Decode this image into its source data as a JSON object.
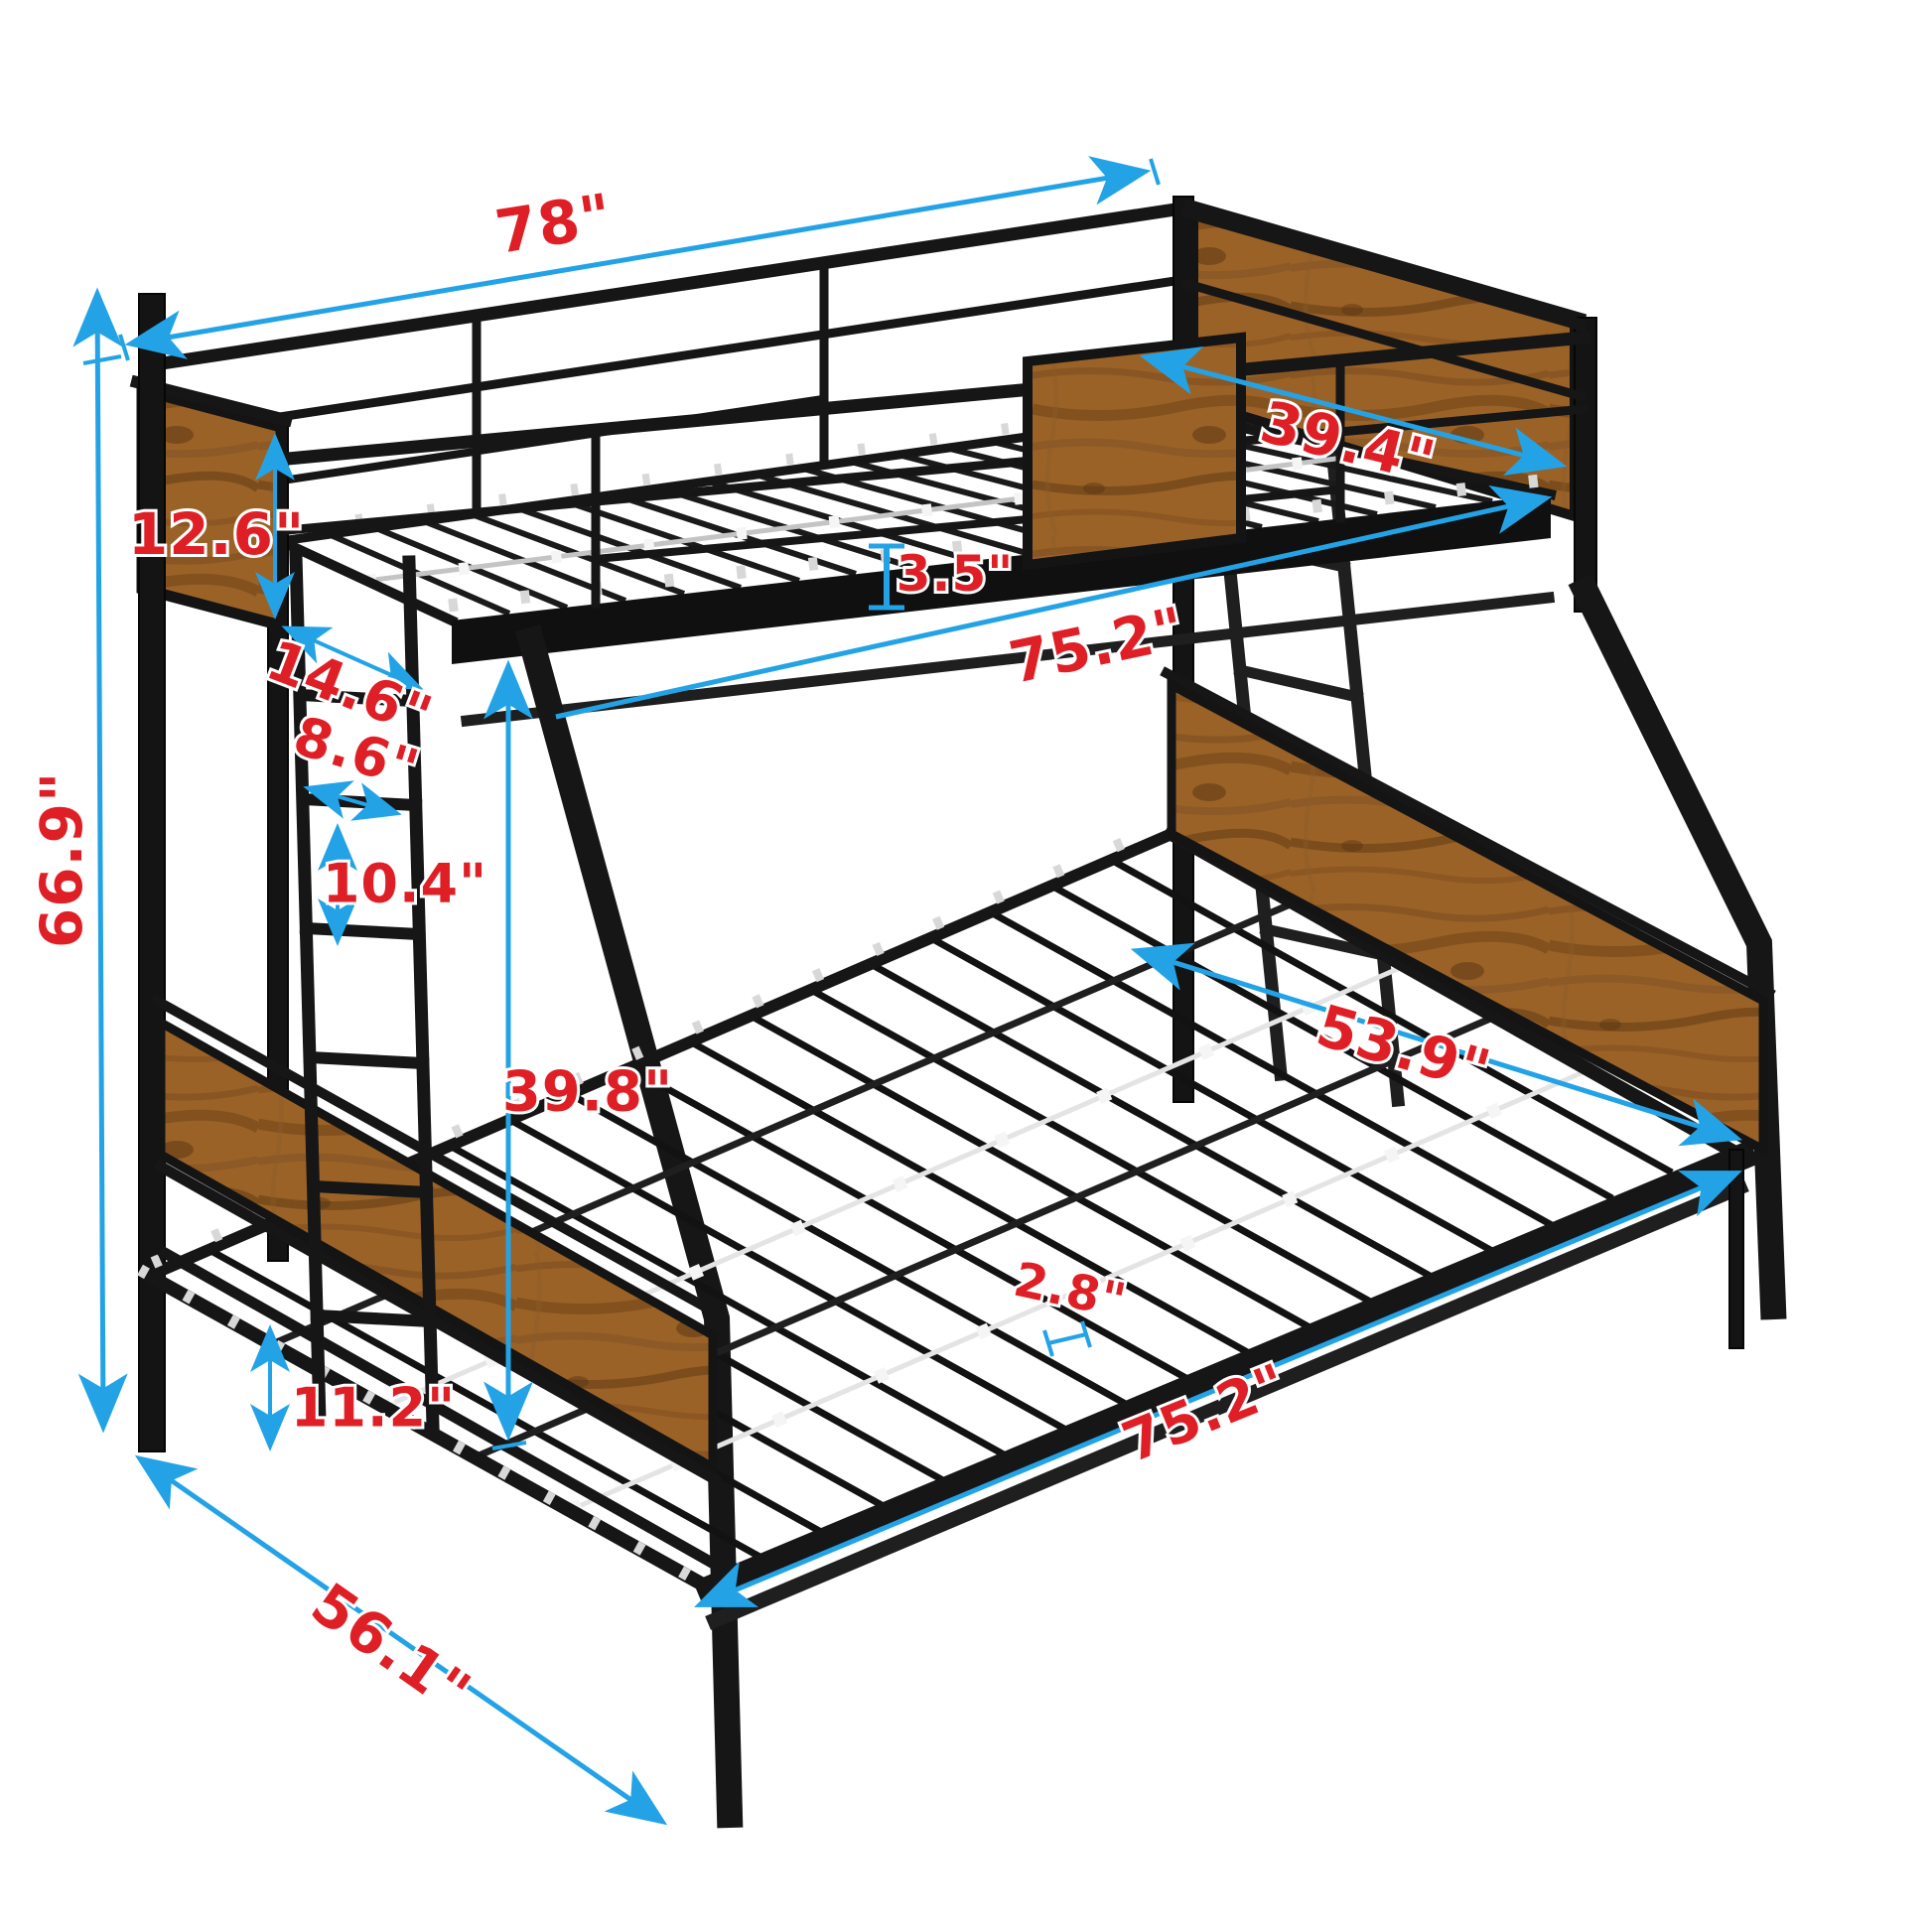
{
  "diagram_type": "bunk-bed-dimension-diagram",
  "colors": {
    "arrow": "#23a3e6",
    "label": "#df1f26",
    "frame": "#161616",
    "wood": "#9b6227",
    "background": "#ffffff"
  },
  "dims": {
    "overall_length": "78\"",
    "upper_bed_width": "39.4\"",
    "upper_headboard_height": "12.6\"",
    "guardrail_height": "3.5\"",
    "upper_bed_length": "75.2\"",
    "headboard_to_ladder": "14.6\"",
    "ladder_width": "8.6\"",
    "ladder_rung_spacing": "10.4\"",
    "overall_height": "66.9\"",
    "bunk_clearance_height": "39.8\"",
    "lower_bed_width": "53.9\"",
    "slat_spacing": "2.8\"",
    "lower_bed_length": "75.2\"",
    "lower_frame_height": "11.2\"",
    "overall_depth": "56.1\""
  }
}
